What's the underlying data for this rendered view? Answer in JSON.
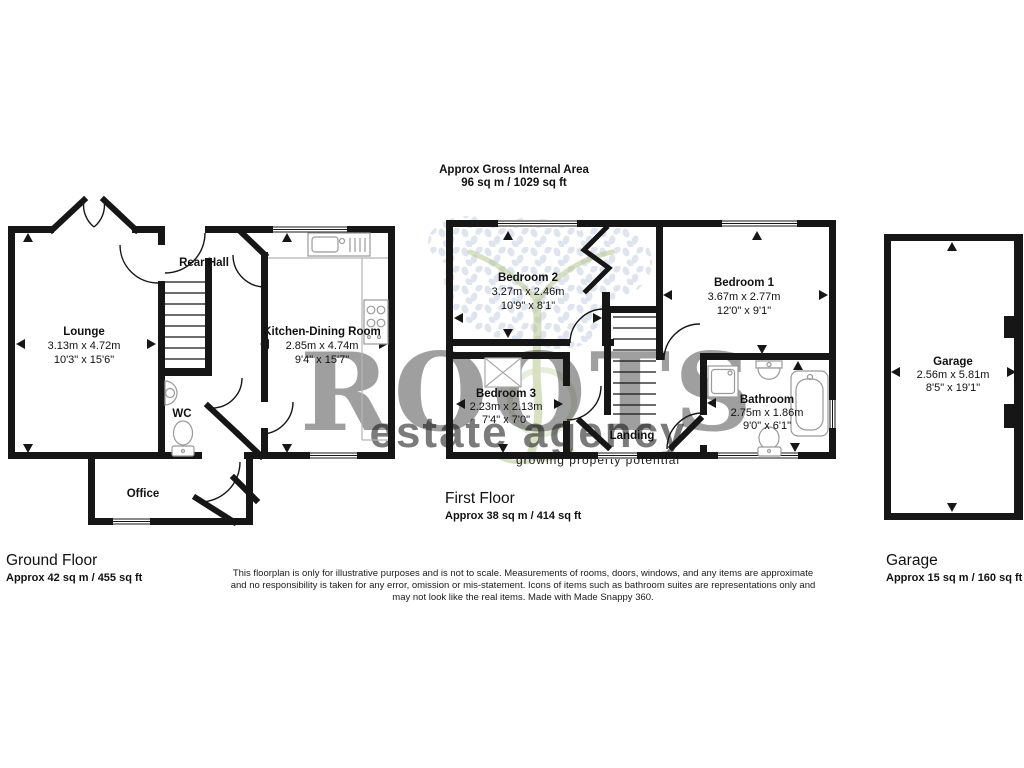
{
  "title": {
    "line1": "Approx Gross Internal Area",
    "line2": "96 sq m / 1029 sq ft"
  },
  "watermark": {
    "brand": "ROOTS",
    "name": "estate agency",
    "tagline": "growing property potential"
  },
  "colors": {
    "wall": "#161616",
    "text": "#111111",
    "fixture": "#9a9a9a",
    "counter": "#b5b5b5",
    "watermark_green": "#b7c893",
    "leaf": "#e0e4ee",
    "tagline_green": "#c9d6a0"
  },
  "ground_floor": {
    "title": "Ground Floor",
    "area": "Approx 42 sq m / 455 sq ft",
    "lounge": {
      "name": "Lounge",
      "metric": "3.13m x 4.72m",
      "imperial": "10'3\" x 15'6\""
    },
    "rear_hall": {
      "name": "Rear Hall"
    },
    "wc": {
      "name": "WC"
    },
    "kitchen": {
      "name": "Kitchen-Dining Room",
      "metric": "2.85m x 4.74m",
      "imperial": "9'4\" x 15'7\""
    },
    "office": {
      "name": "Office"
    }
  },
  "first_floor": {
    "title": "First Floor",
    "area": "Approx 38 sq m / 414 sq ft",
    "bedroom1": {
      "name": "Bedroom 1",
      "metric": "3.67m x 2.77m",
      "imperial": "12'0\" x 9'1\""
    },
    "bedroom2": {
      "name": "Bedroom 2",
      "metric": "3.27m x 2.46m",
      "imperial": "10'9\" x 8'1\""
    },
    "bedroom3": {
      "name": "Bedroom 3",
      "metric": "2.23m x 2.13m",
      "imperial": "7'4\" x 7'0\""
    },
    "bathroom": {
      "name": "Bathroom",
      "metric": "2.75m x 1.86m",
      "imperial": "9'0\" x 6'1\""
    },
    "landing": {
      "name": "Landing"
    }
  },
  "garage": {
    "title": "Garage",
    "area": "Approx 15 sq m / 160 sq ft",
    "room": {
      "name": "Garage",
      "metric": "2.56m x 5.81m",
      "imperial": "8'5\" x 19'1\""
    }
  },
  "disclaimer": {
    "line1": "This floorplan is only for illustrative purposes and is not to scale. Measurements of rooms, doors, windows, and any items are approximate",
    "line2": "and no responsibility is taken for any error, omission or mis-statement. Icons of items such as bathroom suites are representations only and",
    "line3": "may not look like the real items. Made with Made Snappy 360."
  }
}
